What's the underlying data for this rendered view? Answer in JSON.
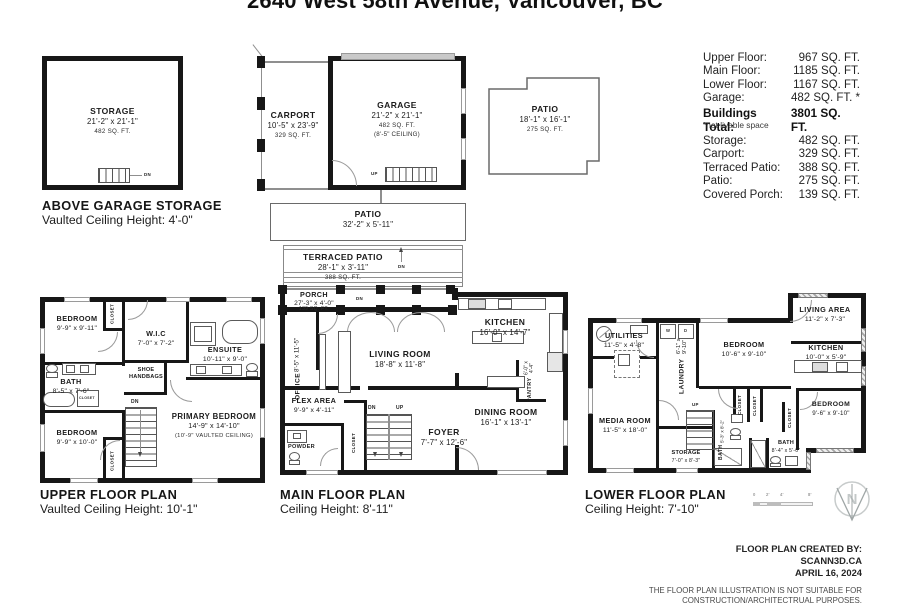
{
  "title": "2640 West 58th Avenue, Vancouver, BC",
  "summary": {
    "rows": [
      {
        "label": "Upper Floor:",
        "value": "967 SQ. FT."
      },
      {
        "label": "Main Floor:",
        "value": "1185 SQ. FT."
      },
      {
        "label": "Lower Floor:",
        "value": "1167 SQ. FT."
      },
      {
        "label": "Garage:",
        "value": "482 SQ. FT. *"
      }
    ],
    "total_label": "Buildings Total:",
    "total_value": "3801 SQ. FT.",
    "footnote": "*not livable space",
    "extra_rows": [
      {
        "label": "Storage:",
        "value": "482 SQ. FT."
      },
      {
        "label": "Carport:",
        "value": "329 SQ. FT."
      },
      {
        "label": "Terraced Patio:",
        "value": "388 SQ. FT."
      },
      {
        "label": "Patio:",
        "value": "275 SQ. FT."
      },
      {
        "label": "Covered Porch:",
        "value": "139 SQ. FT."
      }
    ]
  },
  "storage_plan": {
    "room": {
      "name": "STORAGE",
      "dims": "21'-2\" x 21'-1\"",
      "area": "482 SQ. FT."
    },
    "stair_label": "DN",
    "caption": [
      "ABOVE GARAGE STORAGE",
      "Vaulted Ceiling Height: 4'-0\""
    ]
  },
  "garage_plan": {
    "carport": {
      "name": "CARPORT",
      "dims": "10'-5\" x 23'-9\"",
      "area": "329 SQ. FT."
    },
    "garage": {
      "name": "GARAGE",
      "dims": "21'-2\" x 21'-1\"",
      "area": "482 SQ. FT.",
      "ceiling": "(8'-5\" CEILING)"
    },
    "stair_label": "UP"
  },
  "patio_plan": {
    "name": "PATIO",
    "dims": "18'-1\" x 16'-1\"",
    "area": "275 SQ. FT."
  },
  "patio_strip": {
    "name": "PATIO",
    "dims": "32'-2\" x 5'-11\""
  },
  "terraced_patio": {
    "name": "TERRACED PATIO",
    "dims": "28'-1\" x 3'-11\"",
    "area": "388 SQ. FT.",
    "stair_label": "DN"
  },
  "main_floor": {
    "caption": [
      "MAIN FLOOR PLAN",
      "Ceiling Height: 8'-11\""
    ],
    "labels": {
      "dn": "DN",
      "up": "UP",
      "porch_dn": "DN"
    },
    "rooms": {
      "porch": {
        "name": "PORCH",
        "dims": "27'-3\" x 4'-0\"",
        "area": "139 SQ. FT."
      },
      "office": {
        "name": "OFFICE",
        "dims": "8'-5\" x 11'-5\""
      },
      "living_room": {
        "name": "LIVING ROOM",
        "dims": "18'-8\" x 11'-8\""
      },
      "kitchen": {
        "name": "KITCHEN",
        "dims": "16'-0\" x 14'-7\""
      },
      "pantry": {
        "name": "PANTRY",
        "dims": "6'-0\" x 4'-4\""
      },
      "flex_area": {
        "name": "FLEX AREA",
        "dims": "9'-9\" x 4'-11\""
      },
      "powder": {
        "name": "POWDER"
      },
      "closet": {
        "name": "CLOSET"
      },
      "foyer": {
        "name": "FOYER",
        "dims": "7'-7\" x 12'-6\""
      },
      "dining_room": {
        "name": "DINING ROOM",
        "dims": "16'-1\" x 13'-1\""
      }
    }
  },
  "upper_floor": {
    "caption": [
      "UPPER FLOOR PLAN",
      "Vaulted Ceiling Height: 10'-1\""
    ],
    "labels": {
      "dn": "DN"
    },
    "rooms": {
      "bedroom_1": {
        "name": "BEDROOM",
        "dims": "9'-9\" x 9'-11\""
      },
      "wic": {
        "name": "W.I.C",
        "dims": "7'-0\" x 7'-2\""
      },
      "ensuite": {
        "name": "ENSUITE",
        "dims": "10'-11\" x 9'-0\""
      },
      "bath": {
        "name": "BATH",
        "dims": "8'-5\" x 7'-6\""
      },
      "shoe": {
        "name": "SHOE",
        "name2": "HANDBAGS"
      },
      "primary_bedroom": {
        "name": "PRIMARY BEDROOM",
        "dims": "14'-9\" x 14'-10\"",
        "note": "(10'-9\" VAULTED CEILING)"
      },
      "bedroom_2": {
        "name": "BEDROOM",
        "dims": "9'-9\" x 10'-0\""
      },
      "closet": {
        "name": "CLOSET"
      }
    }
  },
  "lower_floor": {
    "caption": [
      "LOWER FLOOR PLAN",
      "Ceiling Height: 7'-10\""
    ],
    "labels": {
      "up": "UP"
    },
    "rooms": {
      "utilities": {
        "name": "UTILITIES",
        "dims": "11'-5\" x 4'-8\""
      },
      "laundry": {
        "name": "LAUNDRY",
        "dims": "6'-1\" x 9'-10\""
      },
      "bedroom_1": {
        "name": "BEDROOM",
        "dims": "10'-6\" x 9'-10\""
      },
      "living_area": {
        "name": "LIVING AREA",
        "dims": "11'-2\" x 7'-3\""
      },
      "kitchen": {
        "name": "KITCHEN",
        "dims": "10'-0\" x 5'-9\""
      },
      "bedroom_2": {
        "name": "BEDROOM",
        "dims": "9'-6\" x 9'-10\""
      },
      "media_room": {
        "name": "MEDIA ROOM",
        "dims": "11'-5\" x 18'-0\""
      },
      "storage": {
        "name": "STORAGE",
        "dims": "7'-0\" x 8'-3\""
      },
      "bath_1": {
        "name": "BATH",
        "dims": "5'-3\" x 8'-2\""
      },
      "bath_2": {
        "name": "BATH",
        "dims": "8'-4\" x 5'-0\""
      },
      "closet": {
        "name": "CLOSET"
      }
    }
  },
  "laundry_units": {
    "washer": "W",
    "dryer": "D"
  },
  "scale_bar": {
    "ticks": [
      "0",
      "2'",
      "4'",
      "8'"
    ]
  },
  "compass": {
    "north": "N"
  },
  "credits": {
    "lines": [
      "FLOOR PLAN CREATED BY:",
      "SCANN3D.CA",
      "APRIL 16, 2024"
    ],
    "disclaimer": [
      "THE FLOOR PLAN ILLUSTRATION IS NOT SUITABLE FOR",
      "CONSTRUCTION/ARCHITECTRUAL PURPOSES."
    ]
  }
}
